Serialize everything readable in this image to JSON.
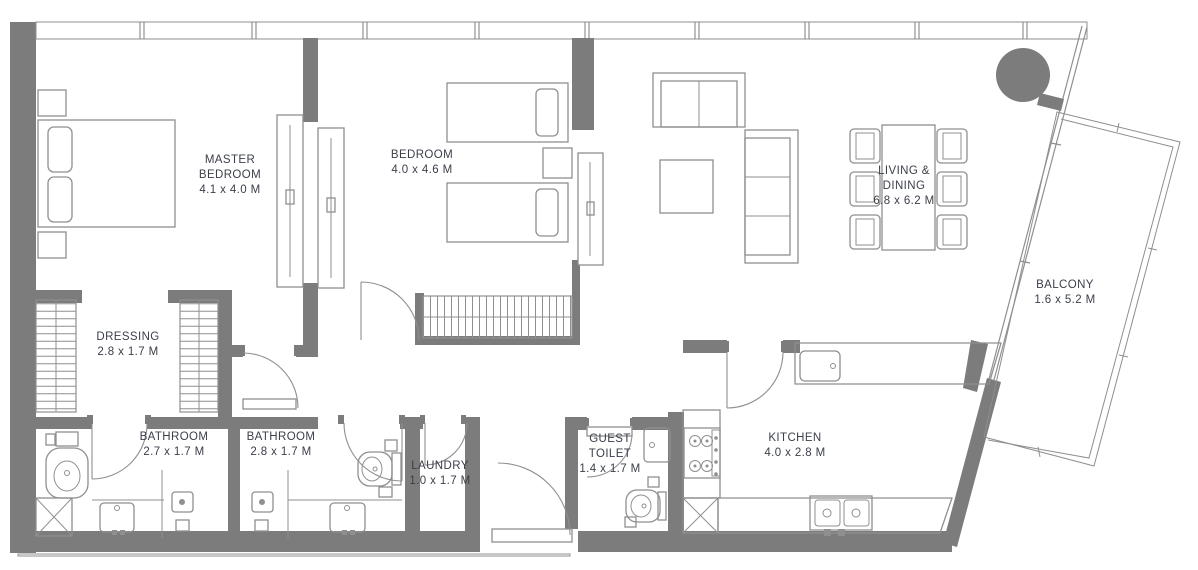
{
  "plan": {
    "type": "apartment-floor-plan",
    "colors": {
      "wall": "#7c7c7c",
      "furniture_line": "#8f8f8f",
      "label_text": "#3b3f4a",
      "background": "#ffffff"
    },
    "rooms": [
      {
        "id": "master-bedroom",
        "name": "MASTER BEDROOM",
        "dims": "4.1 x 4.0 M"
      },
      {
        "id": "bedroom",
        "name": "BEDROOM",
        "dims": "4.0 x 4.6 M"
      },
      {
        "id": "living-dining",
        "name": "LIVING & DINING",
        "dims": "6.8 x 6.2 M"
      },
      {
        "id": "balcony",
        "name": "BALCONY",
        "dims": "1.6 x 5.2 M"
      },
      {
        "id": "dressing",
        "name": "DRESSING",
        "dims": "2.8 x 1.7 M"
      },
      {
        "id": "bathroom-1",
        "name": "BATHROOM",
        "dims": "2.7 x 1.7 M"
      },
      {
        "id": "bathroom-2",
        "name": "BATHROOM",
        "dims": "2.8 x 1.7 M"
      },
      {
        "id": "laundry",
        "name": "LAUNDRY",
        "dims": "1.0 x 1.7 M"
      },
      {
        "id": "guest-toilet",
        "name": "GUEST TOILET",
        "dims": "1.4 x 1.7 M"
      },
      {
        "id": "kitchen",
        "name": "KITCHEN",
        "dims": "4.0 x 2.8 M"
      }
    ]
  }
}
